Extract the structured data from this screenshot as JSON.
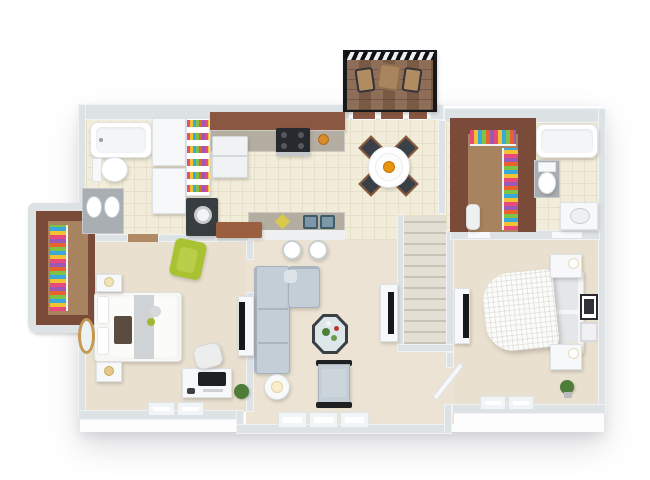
{
  "scene": {
    "type": "3d-floor-plan",
    "view": "top-down isometric",
    "description": "One-level two-bedroom apartment 3D floor plan render with balcony, no text labels"
  },
  "palette": {
    "wall": "#dde2e5",
    "tile": "#f2edda",
    "tile_line": "#e6e0c9",
    "carpet_a": "#e9e0d0",
    "carpet_b": "#ece3d4",
    "wood": "#8a5742",
    "wood_dark": "#7a4b39",
    "closet_floor": "#a8835f",
    "deck": "#85634b",
    "railing": "#17181a",
    "granite_warm": "#b4aea2",
    "granite_cool": "#a9aeb3",
    "appliance_dark": "#383d42",
    "sofa": "#c4ced7",
    "sofa_line": "#a6b1bc",
    "seat_dark": "#3a4048",
    "chair_wood": "#8a5a3c",
    "accent_green": "#a9c232",
    "sink_blue": "#7c98a8",
    "stairs": "#e4dfd5",
    "stair_line": "#c9c3b7",
    "gold": "#c49a52",
    "plant": "#4e7d3a",
    "orange": "#e8940f",
    "glow": "#f7e3ab",
    "bed_white": "#fbfbf9",
    "runner": "#cfd3d5"
  },
  "rooms": [
    {
      "name": "bathroom-1",
      "furniture": [
        "bathtub",
        "toilet",
        "double-sink-vanity",
        "linen-cabinets",
        "pantry-shelves",
        "washer"
      ]
    },
    {
      "name": "kitchen",
      "furniture": [
        "wood-cabinets",
        "granite-counter",
        "range-stove",
        "refrigerator",
        "breakfast-bar",
        "double-basin-sink",
        "bar-stools-2"
      ]
    },
    {
      "name": "dining-area",
      "furniture": [
        "round-table",
        "dining-chairs-4",
        "fruit-bowl"
      ]
    },
    {
      "name": "balcony",
      "furniture": [
        "wood-deck",
        "black-railing",
        "folding-chairs-2",
        "side-table"
      ]
    },
    {
      "name": "walk-in-closet-1",
      "furniture": [
        "hanging-clothes"
      ]
    },
    {
      "name": "bedroom-1",
      "furniture": [
        "bed",
        "nightstands-2",
        "table-lamps-2",
        "green-accent-chair",
        "desk",
        "desk-chair",
        "computer-monitor",
        "tv-stand",
        "tv",
        "round-gold-mirror",
        "potted-plant",
        "windows-2"
      ]
    },
    {
      "name": "living-room",
      "furniture": [
        "sectional-sofa",
        "octagonal-coffee-table",
        "armchair",
        "floor-lamp",
        "tv-stand",
        "tv",
        "windows-3"
      ]
    },
    {
      "name": "staircase",
      "furniture": [
        "stairs"
      ]
    },
    {
      "name": "hallway",
      "furniture": [
        "open-door"
      ]
    },
    {
      "name": "walk-in-closet-2",
      "furniture": [
        "hanging-clothes",
        "small-appliance"
      ]
    },
    {
      "name": "bathroom-2",
      "furniture": [
        "bathtub",
        "toilet",
        "sink-vanity"
      ]
    },
    {
      "name": "bedroom-2",
      "furniture": [
        "bed",
        "headboard",
        "nightstands-2",
        "lit-lamps-2",
        "wall-art-frames-2",
        "potted-plant",
        "tv-stand",
        "tv",
        "windows-2",
        "door"
      ]
    }
  ]
}
